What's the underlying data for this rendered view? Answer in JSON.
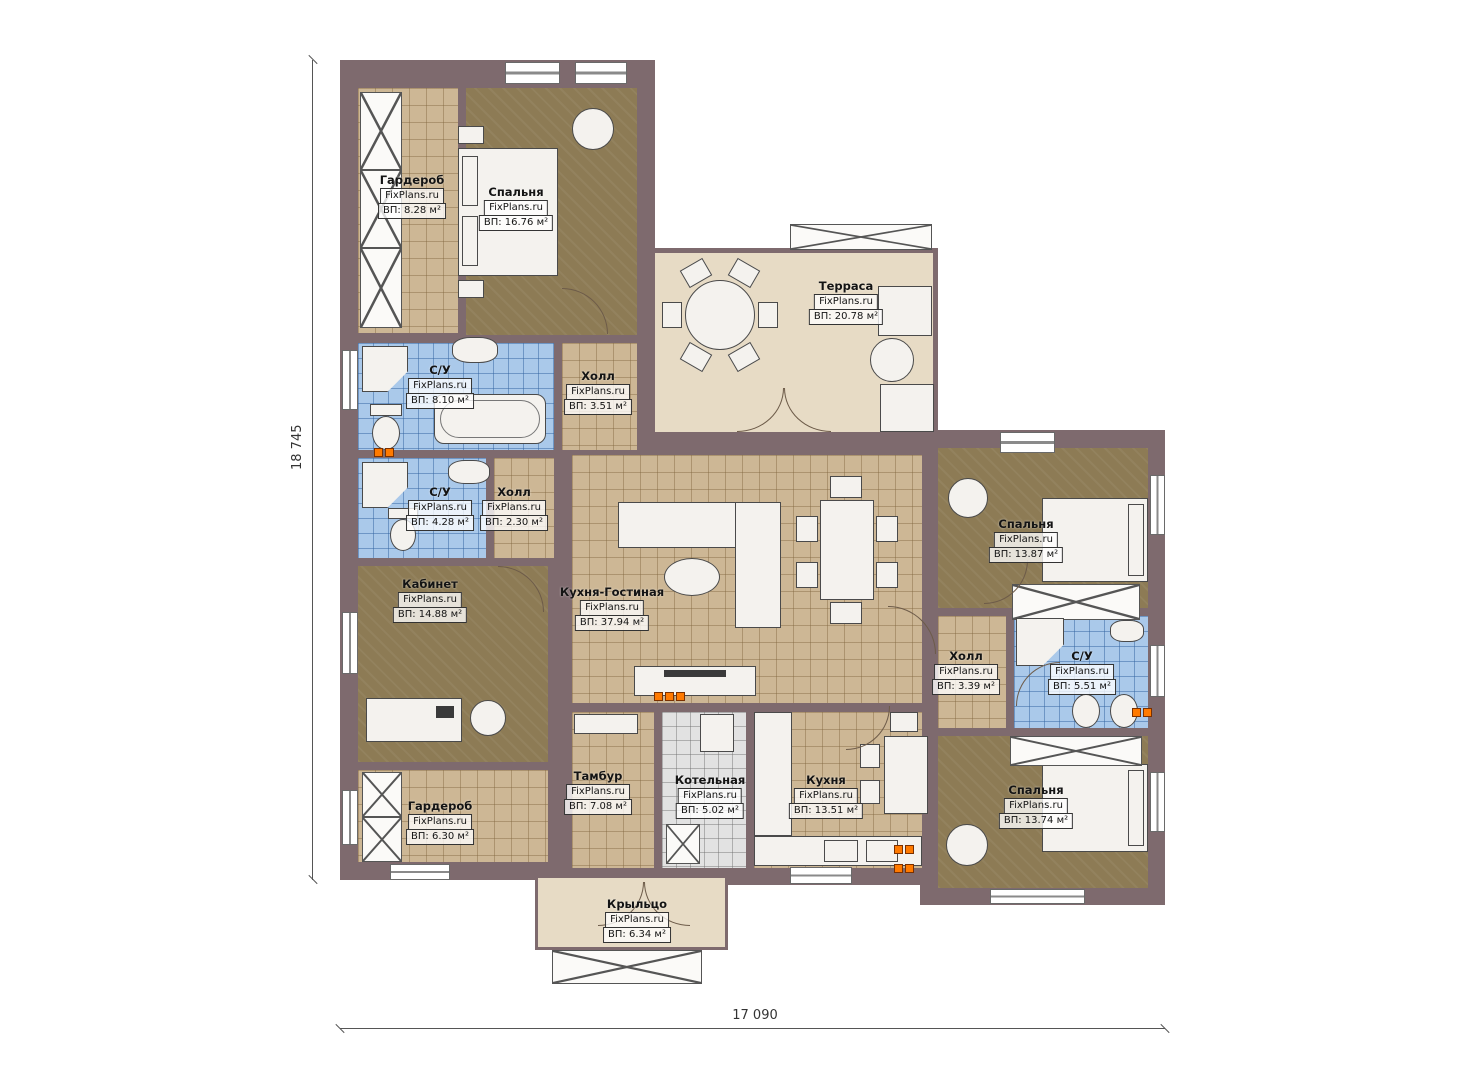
{
  "plan": {
    "watermark": "FixPlans.ru",
    "dimensions": {
      "left": "18 745",
      "bottom": "17 090"
    },
    "rooms": [
      {
        "name": "Гардероб",
        "area": "ВП: 8.28 м²"
      },
      {
        "name": "Спальня",
        "area": "ВП: 16.76 м²"
      },
      {
        "name": "Терраса",
        "area": "ВП: 20.78 м²"
      },
      {
        "name": "С/У",
        "area": "ВП: 8.10 м²"
      },
      {
        "name": "Холл",
        "area": "ВП: 3.51 м²"
      },
      {
        "name": "С/У",
        "area": "ВП: 4.28 м²"
      },
      {
        "name": "Холл",
        "area": "ВП: 2.30 м²"
      },
      {
        "name": "Кабинет",
        "area": "ВП: 14.88 м²"
      },
      {
        "name": "Кухня-Гостиная",
        "area": "ВП: 37.94 м²"
      },
      {
        "name": "Спальня",
        "area": "ВП: 13.87 м²"
      },
      {
        "name": "Холл",
        "area": "ВП: 3.39 м²"
      },
      {
        "name": "С/У",
        "area": "ВП: 5.51 м²"
      },
      {
        "name": "Гардероб",
        "area": "ВП: 6.30 м²"
      },
      {
        "name": "Тамбур",
        "area": "ВП: 7.08 м²"
      },
      {
        "name": "Котельная",
        "area": "ВП: 5.02 м²"
      },
      {
        "name": "Кухня",
        "area": "ВП: 13.51 м²"
      },
      {
        "name": "Спальня",
        "area": "ВП: 13.74 м²"
      },
      {
        "name": "Крыльцо",
        "area": "ВП: 6.34 м²"
      }
    ],
    "colors": {
      "wall": "#7e6a6e",
      "floor_tan": "#cdb795",
      "floor_brown": "#8d7b55",
      "floor_blue": "#aac9ea",
      "floor_beige": "#e7dbc5",
      "floor_gray": "#e2e2e2",
      "radiator": "#ff7a00"
    }
  }
}
